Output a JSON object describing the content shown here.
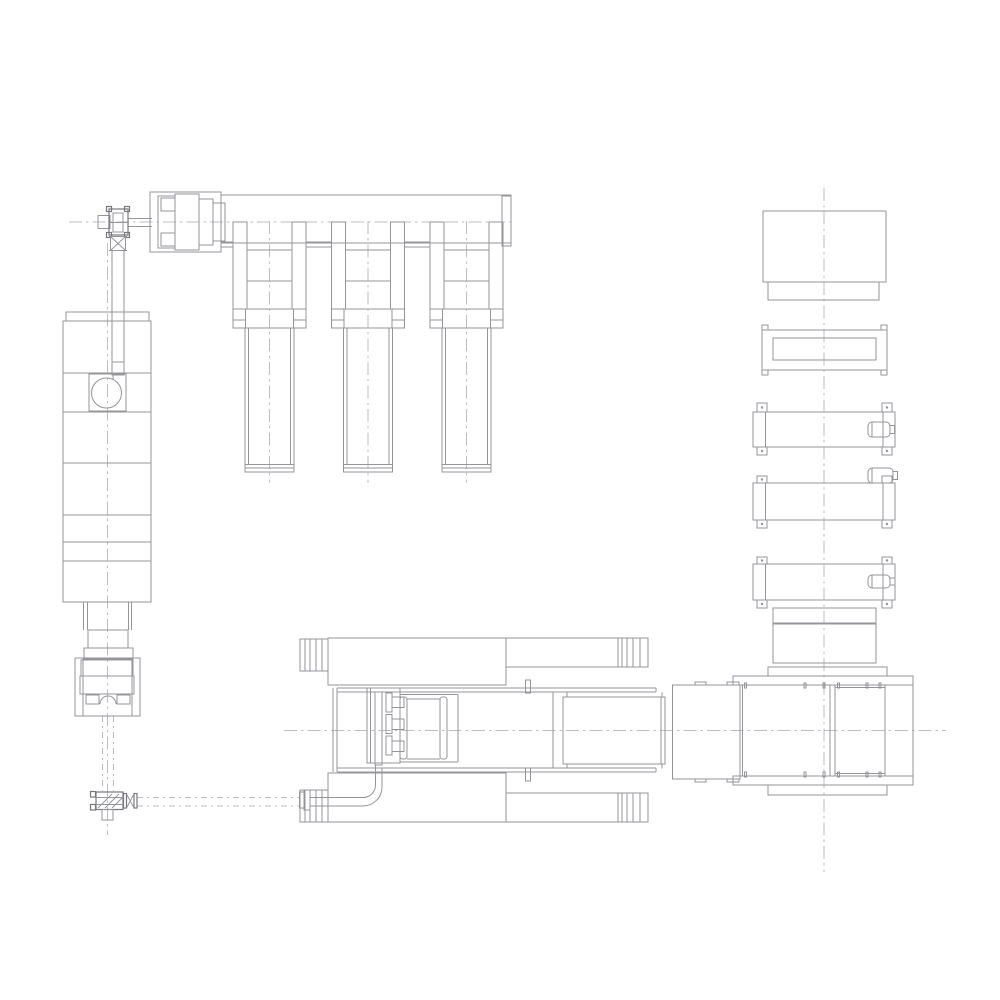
{
  "page": {
    "kind": "engineering-cad-plan-drawing",
    "background": "#ffffff",
    "visible_text": []
  },
  "colors": {
    "line": "#94959a",
    "line_dark": "#77787d",
    "centerline": "#bdbec4",
    "bg": "#ffffff"
  },
  "drawing": {
    "description_of_pixels": "monochrome line drawing of a machinery layout: top-left drive shaft with coupling and gearbox feeding a header beam with three hanging cylinder units; a segmented vertical column press on the left with a circular rotary element and base stack; a small base gearbox linked by dash-dot shaft lines and a bent transfer pipe to a long horizontal bed machine at bottom center with carriage, bolts, guide frame and slide box; at right a press body and a vertical stack of boxes, a corner-tab frame plate and three roller units with small motors, all tied by dash-dot centerlines",
    "components": [
      {
        "name": "drive-shaft-coupling-top-left",
        "bbox": [
          98,
          207,
          40,
          44
        ]
      },
      {
        "name": "spindle-gearbox-top-left",
        "bbox": [
          150,
          192,
          71,
          60
        ]
      },
      {
        "name": "header-beam",
        "bbox": [
          221,
          195,
          290,
          51
        ]
      },
      {
        "name": "cylinder-unit-1",
        "bbox": [
          233,
          222,
          73,
          250
        ]
      },
      {
        "name": "cylinder-unit-2",
        "bbox": [
          331,
          222,
          73,
          250
        ]
      },
      {
        "name": "cylinder-unit-3",
        "bbox": [
          430,
          222,
          73,
          250
        ]
      },
      {
        "name": "left-column-press",
        "bbox": [
          63,
          312,
          88,
          290
        ]
      },
      {
        "name": "rotary-drive-window",
        "bbox": [
          89,
          362,
          37,
          50
        ]
      },
      {
        "name": "column-base-stack",
        "bbox": [
          75,
          602,
          65,
          114
        ]
      },
      {
        "name": "base-drive-gearbox",
        "bbox": [
          90,
          791,
          47,
          29
        ]
      },
      {
        "name": "transfer-pipe",
        "bbox": [
          299,
          764,
          83,
          46
        ]
      },
      {
        "name": "bed-machine",
        "bbox": [
          298,
          638,
          367,
          184
        ]
      },
      {
        "name": "carriage-with-bolts",
        "bbox": [
          367,
          688,
          91,
          77
        ]
      },
      {
        "name": "slide-box",
        "bbox": [
          563,
          697,
          102,
          67
        ]
      },
      {
        "name": "adapter-block",
        "bbox": [
          672,
          682,
          68,
          100
        ]
      },
      {
        "name": "press-body",
        "bbox": [
          733,
          667,
          180,
          129
        ]
      },
      {
        "name": "stack-box-top",
        "bbox": [
          763,
          211,
          123,
          89
        ]
      },
      {
        "name": "stack-frame-plate",
        "bbox": [
          762,
          325,
          125,
          50
        ]
      },
      {
        "name": "roller-unit-a",
        "bbox": [
          753,
          403,
          142,
          52
        ]
      },
      {
        "name": "roller-unit-b",
        "bbox": [
          753,
          468,
          144,
          60
        ]
      },
      {
        "name": "roller-unit-c",
        "bbox": [
          753,
          557,
          142,
          51
        ]
      },
      {
        "name": "stack-spacer-boxes",
        "bbox": [
          773,
          608,
          103,
          55
        ]
      },
      {
        "name": "centerlines",
        "bbox": [
          69,
          188,
          877,
          684
        ]
      }
    ]
  }
}
